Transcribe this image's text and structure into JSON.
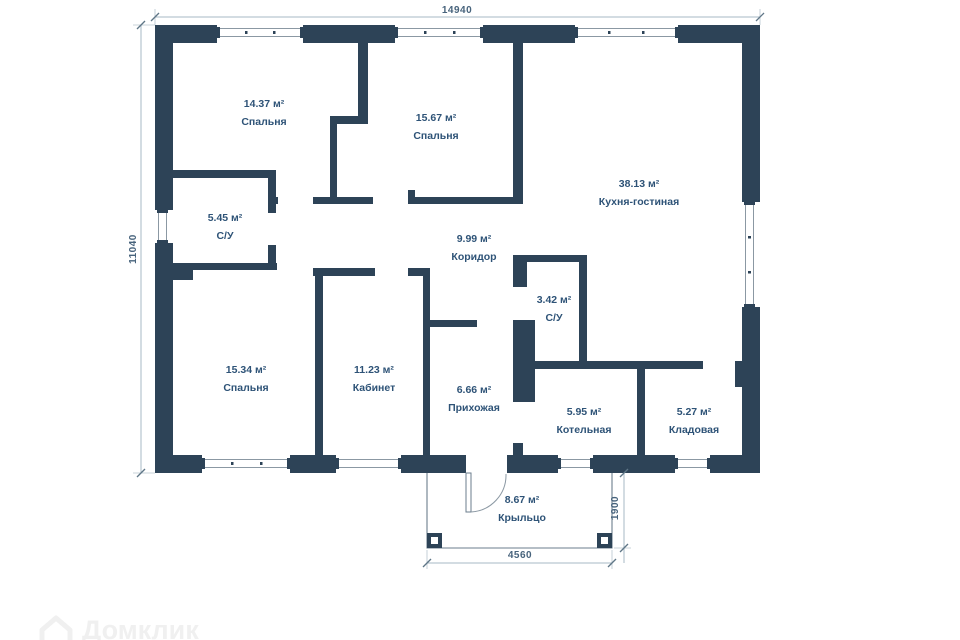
{
  "plan_title": "Floor plan of a single-storey house",
  "colors": {
    "wall": "#2d4357",
    "room_label": "#2e5377",
    "dimension_text": "#47637c",
    "dimension_line": "#a7b8c4",
    "window_frame": "#8b98a3",
    "watermark": "#f0f0f0"
  },
  "dimensions": {
    "top_width_mm": "14940",
    "left_height_mm": "11040",
    "porch_width_mm": "4560",
    "porch_depth_mm": "1900"
  },
  "rooms": [
    {
      "id": "bedroom-1",
      "area": "14.37 м²",
      "name": "Спальня"
    },
    {
      "id": "bedroom-2",
      "area": "15.67 м²",
      "name": "Спальня"
    },
    {
      "id": "kitchen-living",
      "area": "38.13 м²",
      "name": "Кухня-гостиная"
    },
    {
      "id": "bathroom-1",
      "area": "5.45 м²",
      "name": "С/У"
    },
    {
      "id": "corridor",
      "area": "9.99 м²",
      "name": "Коридор"
    },
    {
      "id": "bathroom-2",
      "area": "3.42 м²",
      "name": "С/У"
    },
    {
      "id": "bedroom-3",
      "area": "15.34 м²",
      "name": "Спальня"
    },
    {
      "id": "office",
      "area": "11.23 м²",
      "name": "Кабинет"
    },
    {
      "id": "hallway",
      "area": "6.66 м²",
      "name": "Прихожая"
    },
    {
      "id": "boiler-room",
      "area": "5.95 м²",
      "name": "Котельная"
    },
    {
      "id": "storage",
      "area": "5.27 м²",
      "name": "Кладовая"
    },
    {
      "id": "porch",
      "area": "8.67 м²",
      "name": "Крыльцо"
    }
  ],
  "watermark": {
    "text": "Домклик"
  }
}
